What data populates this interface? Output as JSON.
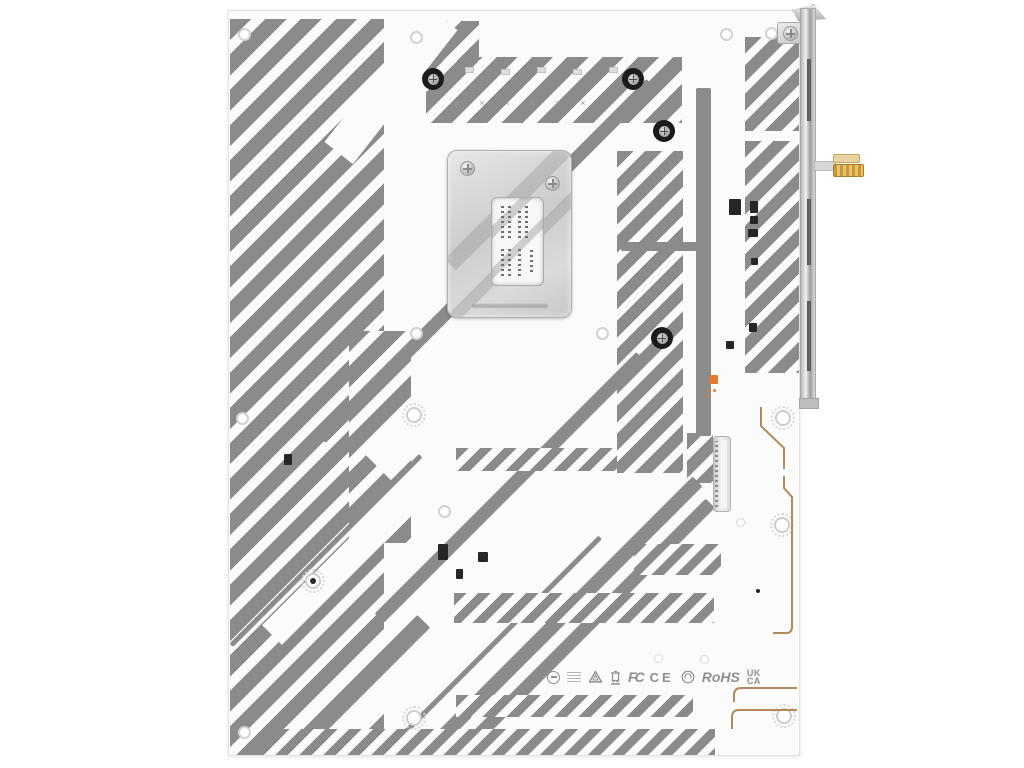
{
  "image": {
    "type": "product-photo",
    "subject": "Rear (solder side) view of a white ATX motherboard PCB with gray diagonal silkscreen stripes, CPU socket backplate, rear I/O shield bracket and antenna connector"
  },
  "colors": {
    "background": "#ffffff",
    "pcb_white": "#fbfbfb",
    "silkscreen_gray": "#8b8b8b",
    "backplate_silver": "#d6d6d6",
    "copper_trace": "#b08a5a",
    "antenna_gold": "#cfa44a",
    "component_dark": "#262626",
    "accent_orange": "#e07b30"
  },
  "certifications": {
    "fcc": "FC",
    "ce": "CE",
    "rohs": "RoHS",
    "ukca_top": "UK",
    "ukca_bottom": "CA"
  },
  "icons": [
    "power-circle-icon",
    "fine-print-block",
    "recycle-triangle-icon",
    "weee-bin-icon",
    "fcc-mark",
    "ce-mark",
    "recycle-circle-icon",
    "rohs-mark",
    "ukca-mark"
  ],
  "marks": {
    "fiducial": "×"
  }
}
